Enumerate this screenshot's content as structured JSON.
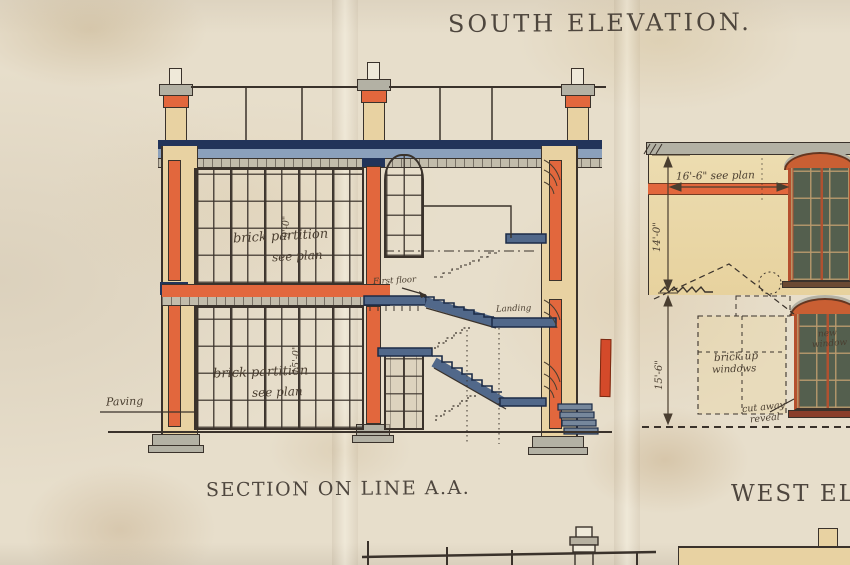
{
  "titles": {
    "south": "SOUTH ELEVATION.",
    "section": "SECTION ON LINE A.A.",
    "west": "WEST ELEVATION."
  },
  "section": {
    "labels": {
      "first_floor": "First floor",
      "landing": "Landing",
      "paving": "Paving",
      "partition_upper_1": "brick partition",
      "partition_upper_2": "see plan",
      "partition_lower_1": "brick partition",
      "partition_lower_2": "see plan"
    },
    "dims": {
      "upper": "9'-0\"",
      "lower": "15'-0\""
    }
  },
  "west": {
    "dims": {
      "width": "16'-6\" see plan",
      "upper": "14'-0\"",
      "lower": "15'-6\""
    },
    "labels": {
      "new_window_1": "new",
      "new_window_2": "window",
      "brick_up_1": "brick up",
      "brick_up_2": "windows",
      "cut_away_1": "cut away",
      "cut_away_2": "reveal"
    }
  },
  "colors": {
    "paper": "#e7decb",
    "ink": "#3a322b",
    "faded_ink": "#4a3e30",
    "orange": "#e2673d",
    "vermilion": "#d44a2a",
    "yellow_wall": "#e8d2a2",
    "yellow_pale": "#ecdcb0",
    "navy": "#22345a",
    "blue_wash": "#8ba0bb",
    "slate_blue": "#51688a",
    "grey_wash": "#c2bcab",
    "stone_grey": "#b3b1a4",
    "glass": "#545f4e",
    "red_frame": "#b5502e",
    "red_head": "#c95f33"
  }
}
